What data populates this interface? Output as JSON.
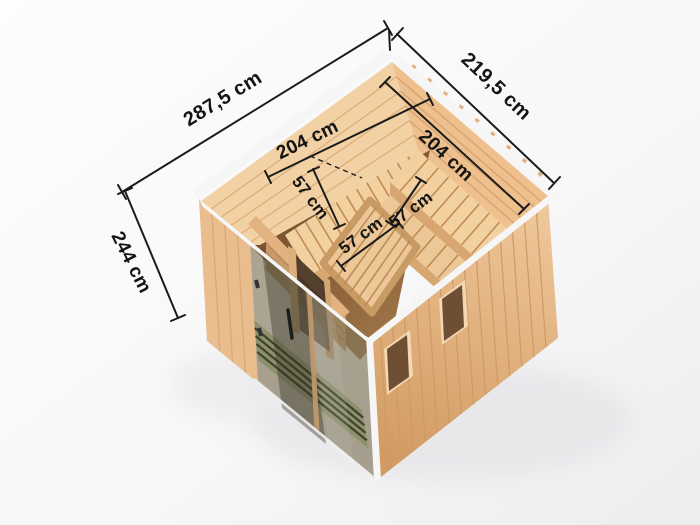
{
  "scene": {
    "title": "Sauna cabin dimension illustration",
    "view": "isometric cutaway from above",
    "background": "#fbfbfc"
  },
  "annotations": {
    "outer_left": "287,5 cm",
    "outer_right": "219,5 cm",
    "height": "244 cm",
    "inner_left": "204 cm",
    "inner_right": "204 cm",
    "bench_left": "57 cm",
    "bench_middle": "57 cm",
    "bench_right": "57 cm"
  },
  "colors": {
    "dim_line": "#1b1b1b",
    "label": "#141414",
    "trim": "#f6f6f6",
    "wood_ext": "#e9bd8d",
    "wood_int_left": "#f2d2a4",
    "wood_int_right": "#edc08e",
    "bench_top": "#f3d0a0",
    "bench_fascia": "#d8a671",
    "middle_bench": "#eec менее999",
    "partition": "#e2b281",
    "floor_dark": "#916640",
    "green_floor": "#a9ad7e",
    "green_slat": "#45422e",
    "window_frame": "#f3d8b2",
    "window_glass": "#6f4f33",
    "glass_tint": "#39412f",
    "shadow": "#e3e3e6"
  }
}
